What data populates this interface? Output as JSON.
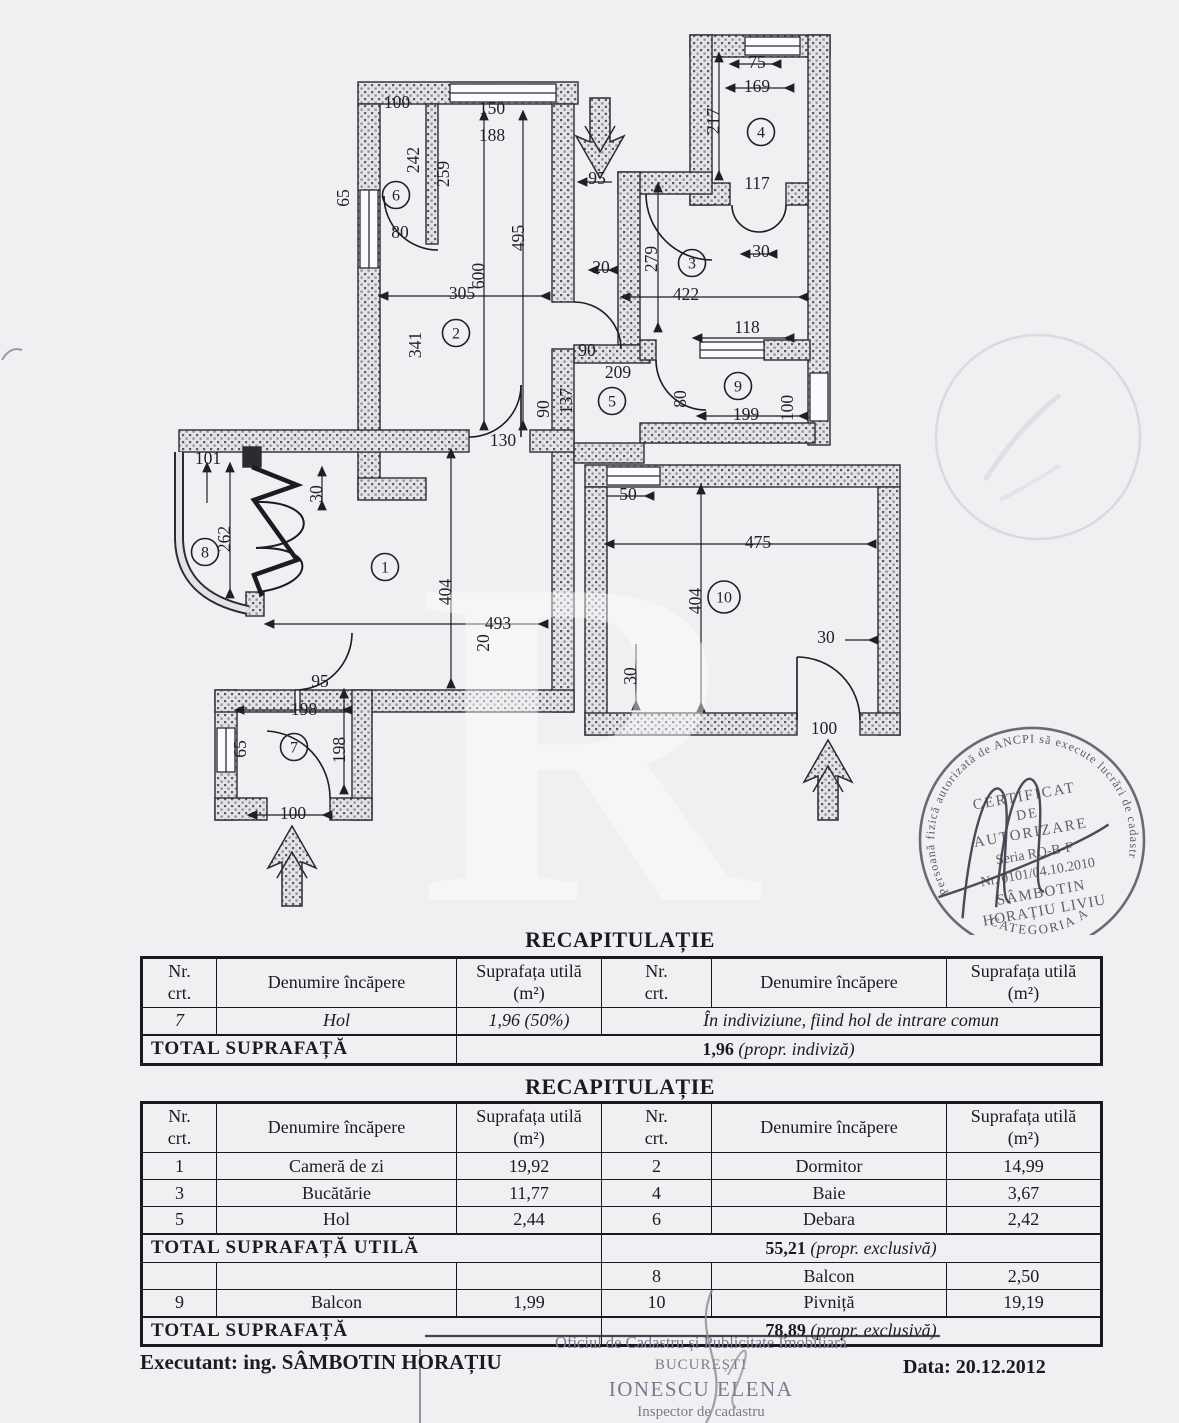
{
  "plan": {
    "watermark": "R",
    "rooms": [
      {
        "n": "1",
        "x": 385,
        "y": 567
      },
      {
        "n": "2",
        "x": 456,
        "y": 333
      },
      {
        "n": "3",
        "x": 692,
        "y": 263
      },
      {
        "n": "4",
        "x": 761,
        "y": 132
      },
      {
        "n": "5",
        "x": 612,
        "y": 401
      },
      {
        "n": "6",
        "x": 396,
        "y": 195
      },
      {
        "n": "7",
        "x": 294,
        "y": 747
      },
      {
        "n": "8",
        "x": 205,
        "y": 552
      },
      {
        "n": "9",
        "x": 738,
        "y": 386
      },
      {
        "n": "10",
        "x": 724,
        "y": 597
      }
    ],
    "dims": [
      {
        "t": "100",
        "x": 397,
        "y": 108,
        "r": 0
      },
      {
        "t": "242",
        "x": 419,
        "y": 160,
        "r": -90
      },
      {
        "t": "259",
        "x": 449,
        "y": 174,
        "r": -90
      },
      {
        "t": "150",
        "x": 492,
        "y": 114,
        "r": 0
      },
      {
        "t": "188",
        "x": 492,
        "y": 141,
        "r": 0
      },
      {
        "t": "65",
        "x": 349,
        "y": 198,
        "r": -90
      },
      {
        "t": "80",
        "x": 400,
        "y": 238,
        "r": 0
      },
      {
        "t": "495",
        "x": 524,
        "y": 238,
        "r": -90
      },
      {
        "t": "600",
        "x": 484,
        "y": 276,
        "r": -90
      },
      {
        "t": "20",
        "x": 601,
        "y": 273,
        "r": 0
      },
      {
        "t": "305",
        "x": 462,
        "y": 299,
        "r": 0
      },
      {
        "t": "341",
        "x": 421,
        "y": 345,
        "r": -90
      },
      {
        "t": "95",
        "x": 597,
        "y": 184,
        "r": 0
      },
      {
        "t": "279",
        "x": 657,
        "y": 259,
        "r": -90
      },
      {
        "t": "30",
        "x": 761,
        "y": 257,
        "r": 0
      },
      {
        "t": "422",
        "x": 686,
        "y": 300,
        "r": 0
      },
      {
        "t": "117",
        "x": 757,
        "y": 189,
        "r": 0
      },
      {
        "t": "75",
        "x": 757,
        "y": 68,
        "r": 0
      },
      {
        "t": "169",
        "x": 757,
        "y": 92,
        "r": 0
      },
      {
        "t": "217",
        "x": 719,
        "y": 121,
        "r": -90
      },
      {
        "t": "118",
        "x": 747,
        "y": 333,
        "r": 0
      },
      {
        "t": "90",
        "x": 587,
        "y": 356,
        "r": 0
      },
      {
        "t": "209",
        "x": 618,
        "y": 378,
        "r": 0
      },
      {
        "t": "90",
        "x": 549,
        "y": 409,
        "r": -90
      },
      {
        "t": "137",
        "x": 572,
        "y": 401,
        "r": -90
      },
      {
        "t": "80",
        "x": 686,
        "y": 399,
        "r": -90
      },
      {
        "t": "199",
        "x": 746,
        "y": 420,
        "r": 0
      },
      {
        "t": "100",
        "x": 793,
        "y": 408,
        "r": -90
      },
      {
        "t": "130",
        "x": 503,
        "y": 446,
        "r": 0
      },
      {
        "t": "101",
        "x": 208,
        "y": 464,
        "r": 0
      },
      {
        "t": "30",
        "x": 322,
        "y": 494,
        "r": -90
      },
      {
        "t": "262",
        "x": 230,
        "y": 539,
        "r": -90
      },
      {
        "t": "404",
        "x": 451,
        "y": 592,
        "r": -90
      },
      {
        "t": "493",
        "x": 498,
        "y": 629,
        "r": 0
      },
      {
        "t": "20",
        "x": 489,
        "y": 643,
        "r": -90
      },
      {
        "t": "95",
        "x": 320,
        "y": 687,
        "r": 0
      },
      {
        "t": "198",
        "x": 304,
        "y": 715,
        "r": 0
      },
      {
        "t": "65",
        "x": 246,
        "y": 749,
        "r": -90
      },
      {
        "t": "198",
        "x": 345,
        "y": 750,
        "r": -90
      },
      {
        "t": "100",
        "x": 293,
        "y": 819,
        "r": 0
      },
      {
        "t": "50",
        "x": 628,
        "y": 500,
        "r": 0
      },
      {
        "t": "475",
        "x": 758,
        "y": 548,
        "r": 0
      },
      {
        "t": "404",
        "x": 701,
        "y": 601,
        "r": -90
      },
      {
        "t": "30",
        "x": 636,
        "y": 676,
        "r": -90
      },
      {
        "t": "30",
        "x": 826,
        "y": 643,
        "r": 0
      },
      {
        "t": "100",
        "x": 824,
        "y": 734,
        "r": 0
      }
    ]
  },
  "cert_stamp": {
    "ring": "Persoană fizică autorizată de ANCPI să execute lucrări de cadastru, geodezie și cartografie",
    "category": "CATEGORIA A",
    "l1": "CERTIFICAT",
    "l2": "DE",
    "l3": "AUTORIZARE",
    "l4": "Seria RO-B-F",
    "l5": "Nr. 0101/04.10.2010",
    "l6": "SÂMBOTIN",
    "l7": "HORAȚIU LIVIU"
  },
  "table_header": {
    "nr": "Nr. crt.",
    "den": "Denumire încăpere",
    "sup": "Suprafața utilă (m²)"
  },
  "tables": {
    "t1": {
      "title": "RECAPITULAȚIE",
      "row": [
        "7",
        "Hol",
        "1,96 (50%)",
        "În indiviziune, fiind hol de intrare comun"
      ],
      "total_label": "TOTAL  SUPRAFAȚĂ",
      "total_value": "1,96",
      "total_note": "(propr. indiviză)"
    },
    "t2": {
      "title": "RECAPITULAȚIE",
      "rows": [
        [
          "1",
          "Cameră de zi",
          "19,92",
          "2",
          "Dormitor",
          "14,99"
        ],
        [
          "3",
          "Bucătărie",
          "11,77",
          "4",
          "Baie",
          "3,67"
        ],
        [
          "5",
          "Hol",
          "2,44",
          "6",
          "Debara",
          "2,42"
        ]
      ],
      "total_utila_label": "TOTAL  SUPRAFAȚĂ  UTILĂ",
      "total_utila_value": "55,21",
      "total_utila_note": "(propr.  exclusivă)",
      "rows2": [
        [
          "",
          "",
          "",
          "8",
          "Balcon",
          "2,50"
        ],
        [
          "9",
          "Balcon",
          "1,99",
          "10",
          "Pivniță",
          "19,19"
        ]
      ],
      "total_label": "TOTAL  SUPRAFAȚĂ",
      "total_value": "78,89",
      "total_note": "(propr.  exclusivă)"
    }
  },
  "footer": {
    "executant": "Executant: ing. SÂMBOTIN HORAȚIU",
    "date": "Data: 20.12.2012"
  },
  "office_stamp": {
    "line1": "Oficiul de Cadastru și Publicitate Imobiliară",
    "line2": "BUCUREȘTI",
    "name": "IONESCU ELENA",
    "role": "Inspector de cadastru"
  }
}
